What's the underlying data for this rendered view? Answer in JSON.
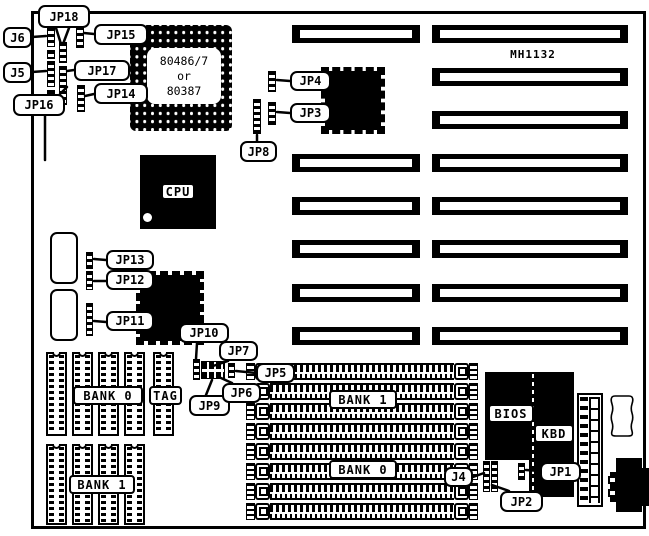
{
  "board": {
    "model": "MH1132"
  },
  "pga": {
    "lines": [
      "80486/7",
      "or",
      "80387"
    ]
  },
  "chip_labels": [
    {
      "id": "cpu-label",
      "text": "CPU",
      "x": 161,
      "y": 183,
      "w": 34,
      "h": 17
    },
    {
      "id": "bios-label",
      "text": "BIOS",
      "x": 488,
      "y": 404,
      "w": 46,
      "h": 19
    },
    {
      "id": "kbd-label",
      "text": "KBD",
      "x": 534,
      "y": 424,
      "w": 40,
      "h": 19
    },
    {
      "id": "cache-bank0-label",
      "text": "BANK 0",
      "x": 73,
      "y": 386,
      "w": 70,
      "h": 19
    },
    {
      "id": "cache-tag-label",
      "text": "TAG",
      "x": 149,
      "y": 386,
      "w": 33,
      "h": 19
    },
    {
      "id": "cache-bank1-label",
      "text": "BANK 1",
      "x": 69,
      "y": 475,
      "w": 66,
      "h": 19
    },
    {
      "id": "simm-bank1-label",
      "text": "BANK 1",
      "x": 329,
      "y": 390,
      "w": 68,
      "h": 19
    },
    {
      "id": "simm-bank0-label",
      "text": "BANK 0",
      "x": 329,
      "y": 460,
      "w": 68,
      "h": 19
    }
  ],
  "callouts": [
    {
      "id": "jp18",
      "text": "JP18",
      "x": 38,
      "y": 5,
      "w": 52,
      "h": 23
    },
    {
      "id": "j6",
      "text": "J6",
      "x": 3,
      "y": 27,
      "w": 29,
      "h": 21
    },
    {
      "id": "jp15",
      "text": "JP15",
      "x": 94,
      "y": 24,
      "w": 54,
      "h": 21
    },
    {
      "id": "j5",
      "text": "J5",
      "x": 3,
      "y": 62,
      "w": 29,
      "h": 21
    },
    {
      "id": "jp17",
      "text": "JP17",
      "x": 74,
      "y": 60,
      "w": 56,
      "h": 21
    },
    {
      "id": "jp16",
      "text": "JP16",
      "x": 13,
      "y": 94,
      "w": 52,
      "h": 22
    },
    {
      "id": "jp14",
      "text": "JP14",
      "x": 94,
      "y": 83,
      "w": 54,
      "h": 21
    },
    {
      "id": "jp4",
      "text": "JP4",
      "x": 290,
      "y": 71,
      "w": 41,
      "h": 20
    },
    {
      "id": "jp3",
      "text": "JP3",
      "x": 290,
      "y": 103,
      "w": 41,
      "h": 20
    },
    {
      "id": "jp8",
      "text": "JP8",
      "x": 240,
      "y": 141,
      "w": 37,
      "h": 21
    },
    {
      "id": "jp13",
      "text": "JP13",
      "x": 106,
      "y": 250,
      "w": 48,
      "h": 20
    },
    {
      "id": "jp12",
      "text": "JP12",
      "x": 106,
      "y": 270,
      "w": 48,
      "h": 20
    },
    {
      "id": "jp11",
      "text": "JP11",
      "x": 106,
      "y": 311,
      "w": 48,
      "h": 20
    },
    {
      "id": "jp10",
      "text": "JP10",
      "x": 179,
      "y": 323,
      "w": 50,
      "h": 20
    },
    {
      "id": "jp7",
      "text": "JP7",
      "x": 219,
      "y": 341,
      "w": 39,
      "h": 20
    },
    {
      "id": "jp9",
      "text": "JP9",
      "x": 189,
      "y": 395,
      "w": 41,
      "h": 21
    },
    {
      "id": "jp6",
      "text": "JP6",
      "x": 222,
      "y": 383,
      "w": 39,
      "h": 20
    },
    {
      "id": "jp5",
      "text": "JP5",
      "x": 256,
      "y": 363,
      "w": 39,
      "h": 20
    },
    {
      "id": "j4",
      "text": "J4",
      "x": 444,
      "y": 467,
      "w": 29,
      "h": 20
    },
    {
      "id": "jp2",
      "text": "JP2",
      "x": 500,
      "y": 491,
      "w": 43,
      "h": 21
    },
    {
      "id": "jp1",
      "text": "JP1",
      "x": 540,
      "y": 462,
      "w": 41,
      "h": 20
    }
  ],
  "isa": {
    "rows_y": [
      25,
      68,
      111,
      154,
      197,
      240,
      284,
      327
    ],
    "left_x": 292,
    "left_w": 128,
    "left_rows": [
      0,
      3,
      4,
      5,
      6,
      7
    ],
    "right_x": 432,
    "right_w": 196,
    "h": 18
  },
  "jumpers": [
    {
      "id": "j6-block",
      "x": 47,
      "y": 27,
      "w": 8,
      "h": 20
    },
    {
      "id": "j6-block-2",
      "x": 47,
      "y": 50,
      "w": 8,
      "h": 9
    },
    {
      "id": "j5-block",
      "x": 47,
      "y": 61,
      "w": 8,
      "h": 26
    },
    {
      "id": "j5-block-2",
      "x": 47,
      "y": 90,
      "w": 8,
      "h": 8
    },
    {
      "id": "jp18-block",
      "x": 59,
      "y": 42,
      "w": 8,
      "h": 21
    },
    {
      "id": "jp17-jp16-block",
      "x": 59,
      "y": 66,
      "w": 8,
      "h": 39
    },
    {
      "id": "jp15-block",
      "x": 76,
      "y": 26,
      "w": 8,
      "h": 22
    },
    {
      "id": "jp14-block",
      "x": 77,
      "y": 85,
      "w": 8,
      "h": 27
    },
    {
      "id": "jp4-block",
      "x": 268,
      "y": 71,
      "w": 8,
      "h": 21
    },
    {
      "id": "jp3-block",
      "x": 268,
      "y": 102,
      "w": 8,
      "h": 23
    },
    {
      "id": "jp8-block",
      "x": 253,
      "y": 99,
      "w": 8,
      "h": 35
    },
    {
      "id": "jp13-block",
      "x": 86,
      "y": 252,
      "w": 7,
      "h": 17
    },
    {
      "id": "jp12-block",
      "x": 86,
      "y": 271,
      "w": 7,
      "h": 19
    },
    {
      "id": "jp11-block",
      "x": 86,
      "y": 303,
      "w": 7,
      "h": 33
    },
    {
      "id": "jp10-block",
      "x": 193,
      "y": 359,
      "w": 7,
      "h": 21
    },
    {
      "id": "jp7-jp9-block",
      "x": 201,
      "y": 361,
      "w": 24,
      "h": 18,
      "cls": "jgrid"
    },
    {
      "id": "jp5-jp6-block",
      "x": 228,
      "y": 363,
      "w": 7,
      "h": 15
    },
    {
      "id": "j4-jp2-block",
      "x": 483,
      "y": 461,
      "w": 7,
      "h": 31
    },
    {
      "id": "jp2-block",
      "x": 491,
      "y": 461,
      "w": 7,
      "h": 31
    },
    {
      "id": "jp1-block",
      "x": 518,
      "y": 463,
      "w": 7,
      "h": 17
    }
  ],
  "cache": {
    "w": 21,
    "top": {
      "y": 352,
      "h": 84,
      "xs": [
        46,
        72,
        98,
        124,
        153
      ]
    },
    "bottom": {
      "y": 444,
      "h": 81,
      "xs": [
        46,
        72,
        98,
        124
      ]
    }
  },
  "simm": {
    "x": 246,
    "w": 232,
    "h": 17,
    "ys": [
      363,
      383,
      403,
      423,
      443,
      463,
      483,
      503
    ]
  },
  "pointer_lines": [
    [
      56,
      28,
      61,
      44
    ],
    [
      69,
      28,
      63,
      44
    ],
    [
      32,
      37,
      46,
      36
    ],
    [
      94,
      34,
      84,
      33
    ],
    [
      32,
      72,
      46,
      71
    ],
    [
      74,
      70,
      67,
      71
    ],
    [
      60,
      94,
      67,
      87
    ],
    [
      94,
      94,
      85,
      96
    ],
    [
      290,
      81,
      277,
      80
    ],
    [
      290,
      113,
      277,
      112
    ],
    [
      257,
      141,
      257,
      135
    ],
    [
      106,
      260,
      94,
      259
    ],
    [
      106,
      281,
      94,
      281
    ],
    [
      106,
      322,
      94,
      321
    ],
    [
      197,
      343,
      196,
      359
    ],
    [
      228,
      361,
      213,
      366
    ],
    [
      206,
      395,
      212,
      380
    ],
    [
      232,
      383,
      221,
      378
    ],
    [
      256,
      373,
      236,
      371
    ],
    [
      473,
      477,
      484,
      473
    ],
    [
      509,
      491,
      492,
      485
    ],
    [
      540,
      471,
      526,
      470
    ],
    [
      45,
      113,
      45,
      160
    ]
  ],
  "colors": {
    "ink": "#000000",
    "paper": "#ffffff"
  }
}
